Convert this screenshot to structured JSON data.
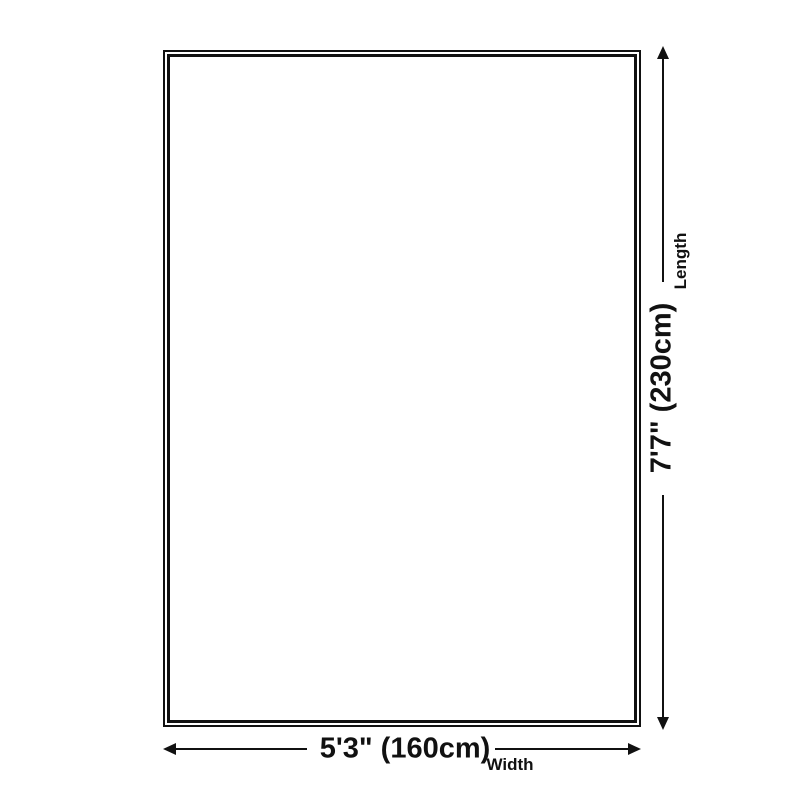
{
  "colors": {
    "background": "#ffffff",
    "ink": "#111111"
  },
  "diagram": {
    "type": "rug-size-dimension-diagram",
    "dimensions": {
      "length": {
        "value": "7'7\" (230cm)",
        "label": "Length"
      },
      "width": {
        "value": "5'3\" (160cm)",
        "label": "Width"
      }
    }
  }
}
